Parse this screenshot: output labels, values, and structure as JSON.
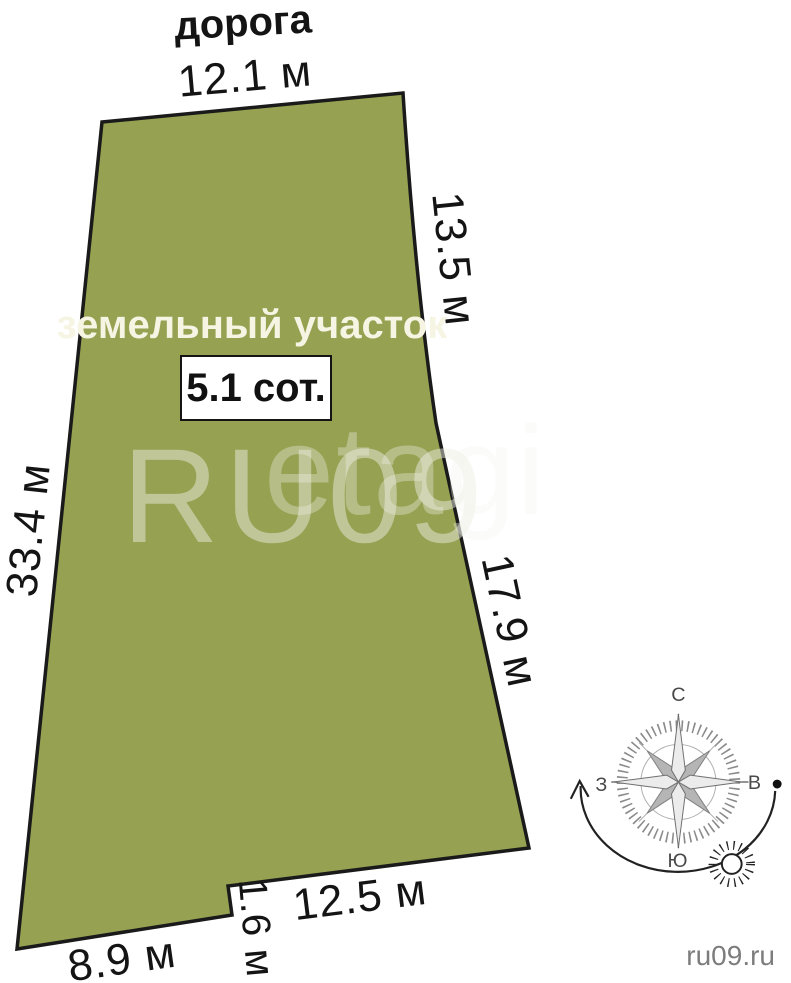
{
  "plot": {
    "road_label": "дорога",
    "name_label": "земельный участок",
    "area_label": "5.1 сот.",
    "fill_color": "#96a152",
    "outline_color": "#1a1a1a",
    "name_text_color": "#f6f4e2"
  },
  "dimensions": {
    "top": "12.1 м",
    "right_upper": "13.5 м",
    "left": "33.4 м",
    "right_lower": "17.9 м",
    "bottom_right": "12.5 м",
    "notch": "1.6 м",
    "bottom_left": "8.9 м"
  },
  "compass": {
    "north": "С",
    "east": "В",
    "south": "Ю",
    "west": "З"
  },
  "watermark": {
    "primary": "RU09",
    "secondary": "etagi"
  },
  "footer": {
    "site": "ru09.ru",
    "text_color": "#7d7d7d"
  }
}
